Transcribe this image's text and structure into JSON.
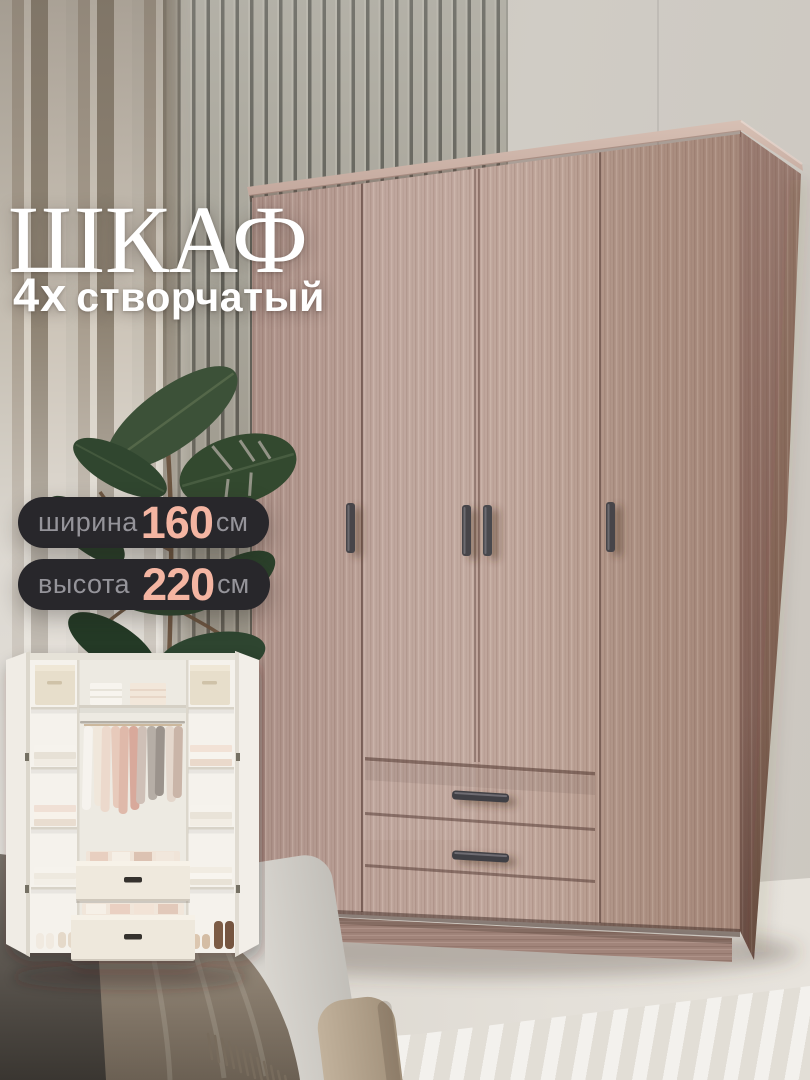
{
  "overlay": {
    "title": "ШКАФ",
    "subtitle_prefix": "4х",
    "subtitle_word": "створчатый",
    "badges": [
      {
        "label": "ширина",
        "value": "160",
        "unit": "см"
      },
      {
        "label": "высота",
        "value": "220",
        "unit": "см"
      }
    ],
    "colors": {
      "badge_background": "#28272b",
      "badge_label_text": "#95949a",
      "badge_value_accent": "#f4b5a2",
      "title_text": "#ffffff",
      "wardrobe_wood": "#b89c92"
    }
  },
  "figures": {
    "main_photo": "closed four-door wardrobe in light ash wood, bedroom with slat wall, curtains and plant",
    "inset_photo": "open white wardrobe interior with hanging clothes, shelves, two drawers and shoes"
  }
}
